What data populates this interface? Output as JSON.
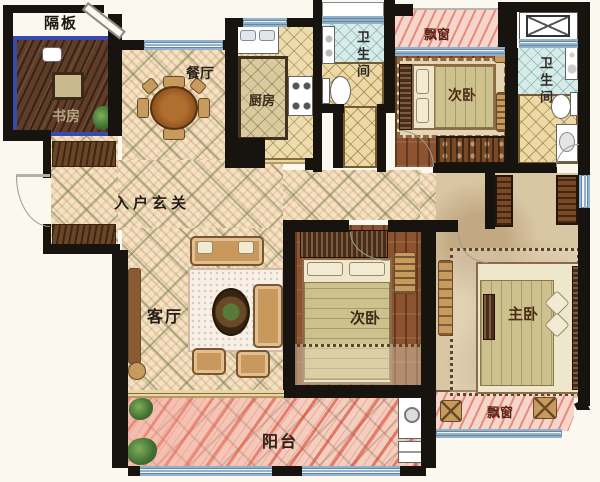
{
  "rooms": {
    "partition": "隔板",
    "study": "书房",
    "dining": "餐厅",
    "kitchen": "厨房",
    "bath1": "卫生间",
    "bath2": "卫生间",
    "bay_top": "飘窗",
    "bay_bottom": "飘窗",
    "bedroom1": "次卧",
    "bedroom2": "次卧",
    "master": "主卧",
    "foyer": "入户玄关",
    "living": "客厅",
    "balcony": "阳台"
  },
  "colors": {
    "wall": "#17130e",
    "study_partition_border": "#3a49ad",
    "parquet_floor": "#f2e3c3",
    "wood_floor": "#8c5330",
    "balcony_stripe": "#d6372a",
    "bath_tile": "#d7ece8",
    "window_glass": "#eef5fa",
    "label_text": "#2e2418",
    "bay_label_text": "#5d2317"
  }
}
